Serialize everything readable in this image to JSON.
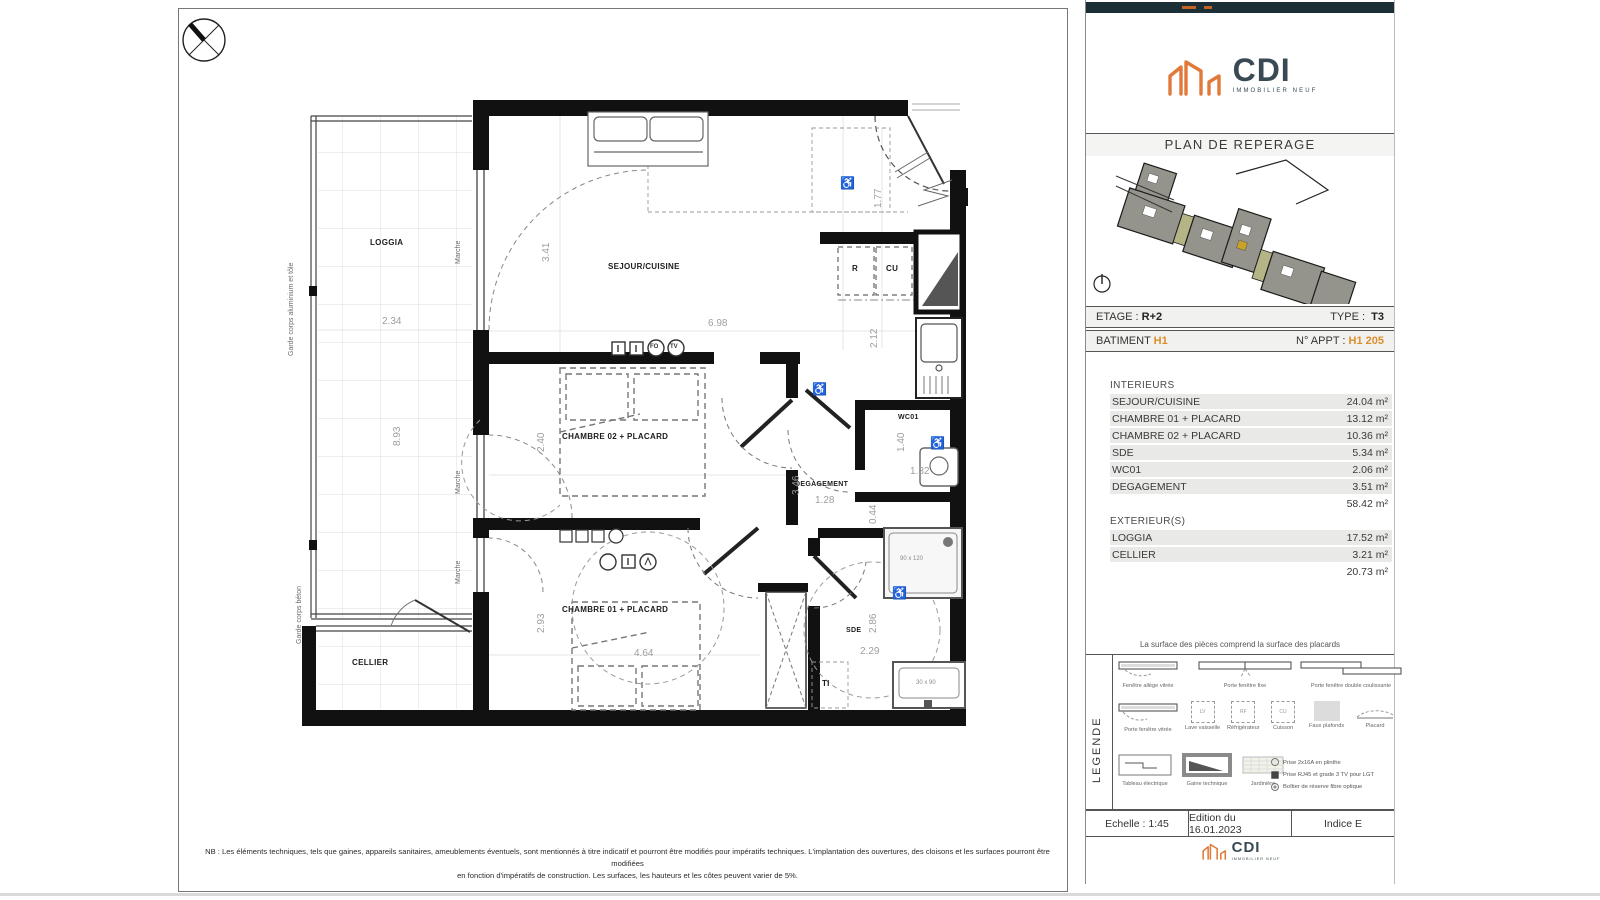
{
  "plan": {
    "rooms": {
      "loggia": "LOGGIA",
      "sejour": "SEJOUR/CUISINE",
      "chambre02": "CHAMBRE 02 + PLACARD",
      "chambre01": "CHAMBRE 01 + PLACARD",
      "degagement": "DEGAGEMENT",
      "wc01": "WC01",
      "sde": "SDE",
      "cellier": "CELLIER",
      "ti": "TI",
      "r": "R",
      "cu": "CU"
    },
    "annotations": {
      "garde_corps_alu": "Garde corps aluminium et tôle",
      "garde_corps_beton": "Garde corps béton",
      "marche": "Marche",
      "shower_size": "90 x 120",
      "basin_size": "30 x 90",
      "fo": "FO",
      "tv": "TV"
    },
    "dims": {
      "d234": "2.34",
      "d893": "8.93",
      "d341": "3.41",
      "d698": "6.98",
      "d177": "1.77",
      "d212": "2.12",
      "d240": "2.40",
      "d346": "3.46",
      "d128": "1.28",
      "d140": "1.40",
      "d132": "1.32",
      "d044": "0.44",
      "d293": "2.93",
      "d464": "4.64",
      "d286": "2.86",
      "d229": "2.29"
    },
    "nb_note_1": "NB : Les éléments techniques, tels que gaines, appareils sanitaires, ameublements éventuels, sont mentionnés à titre indicatif et pourront être modifiés pour impératifs techniques. L'implantation des ouvertures, des cloisons et les surfaces pourront être modifiées",
    "nb_note_2": "en fonction d'impératifs de construction. Les surfaces, les hauteurs et les côtes peuvent varier de 5%."
  },
  "panel": {
    "colors": {
      "accent": "#d98f2b",
      "logo_orange": "#e0793a",
      "logo_dark": "#3a4a54"
    },
    "logo": {
      "name": "CDI",
      "tagline": "IMMOBILIER NEUF"
    },
    "reperage_title": "PLAN DE REPERAGE",
    "etage_label": "ETAGE :",
    "etage_value": "R+2",
    "type_label": "TYPE :",
    "type_value": "T3",
    "batiment_label": "BATIMENT",
    "batiment_value": "H1",
    "appt_label": "N° APPT :",
    "appt_value": "H1 205",
    "interieurs": {
      "title": "INTERIEURS",
      "rows": [
        {
          "label": "SEJOUR/CUISINE",
          "value": "24.04 m²"
        },
        {
          "label": "CHAMBRE 01 + PLACARD",
          "value": "13.12 m²"
        },
        {
          "label": "CHAMBRE 02 + PLACARD",
          "value": "10.36 m²"
        },
        {
          "label": "SDE",
          "value": "5.34 m²"
        },
        {
          "label": "WC01",
          "value": "2.06 m²"
        },
        {
          "label": "DEGAGEMENT",
          "value": "3.51 m²"
        }
      ],
      "total": "58.42 m²"
    },
    "exterieurs": {
      "title": "EXTERIEUR(S)",
      "rows": [
        {
          "label": "LOGGIA",
          "value": "17.52 m²"
        },
        {
          "label": "CELLIER",
          "value": "3.21 m²"
        }
      ],
      "total": "20.73 m²"
    },
    "surface_note": "La surface des pièces comprend la surface des placards",
    "legend": {
      "title": "LEGENDE",
      "labels": [
        "Fenêtre allège vitrée",
        "Porte fenêtre fixe",
        "Porte fenêtre double coulissante",
        "Porte fenêtre vitrée",
        "Lave vaisselle",
        "Réfrigérateur",
        "Cuisson",
        "Faux plafonds",
        "Placard",
        "Tableau électrique",
        "Gaine technique",
        "Jardinière"
      ],
      "letters": [
        "LV",
        "RF",
        "CU"
      ],
      "bullets": [
        "Prise 2x16A en plinthe",
        "Prise RJ45 et grade 3 TV pour LGT",
        "Boîtier de réserve fibre optique"
      ]
    },
    "footer": {
      "echelle": "Echelle : 1:45",
      "edition": "Edition du 16.01.2023",
      "indice": "Indice E"
    }
  }
}
